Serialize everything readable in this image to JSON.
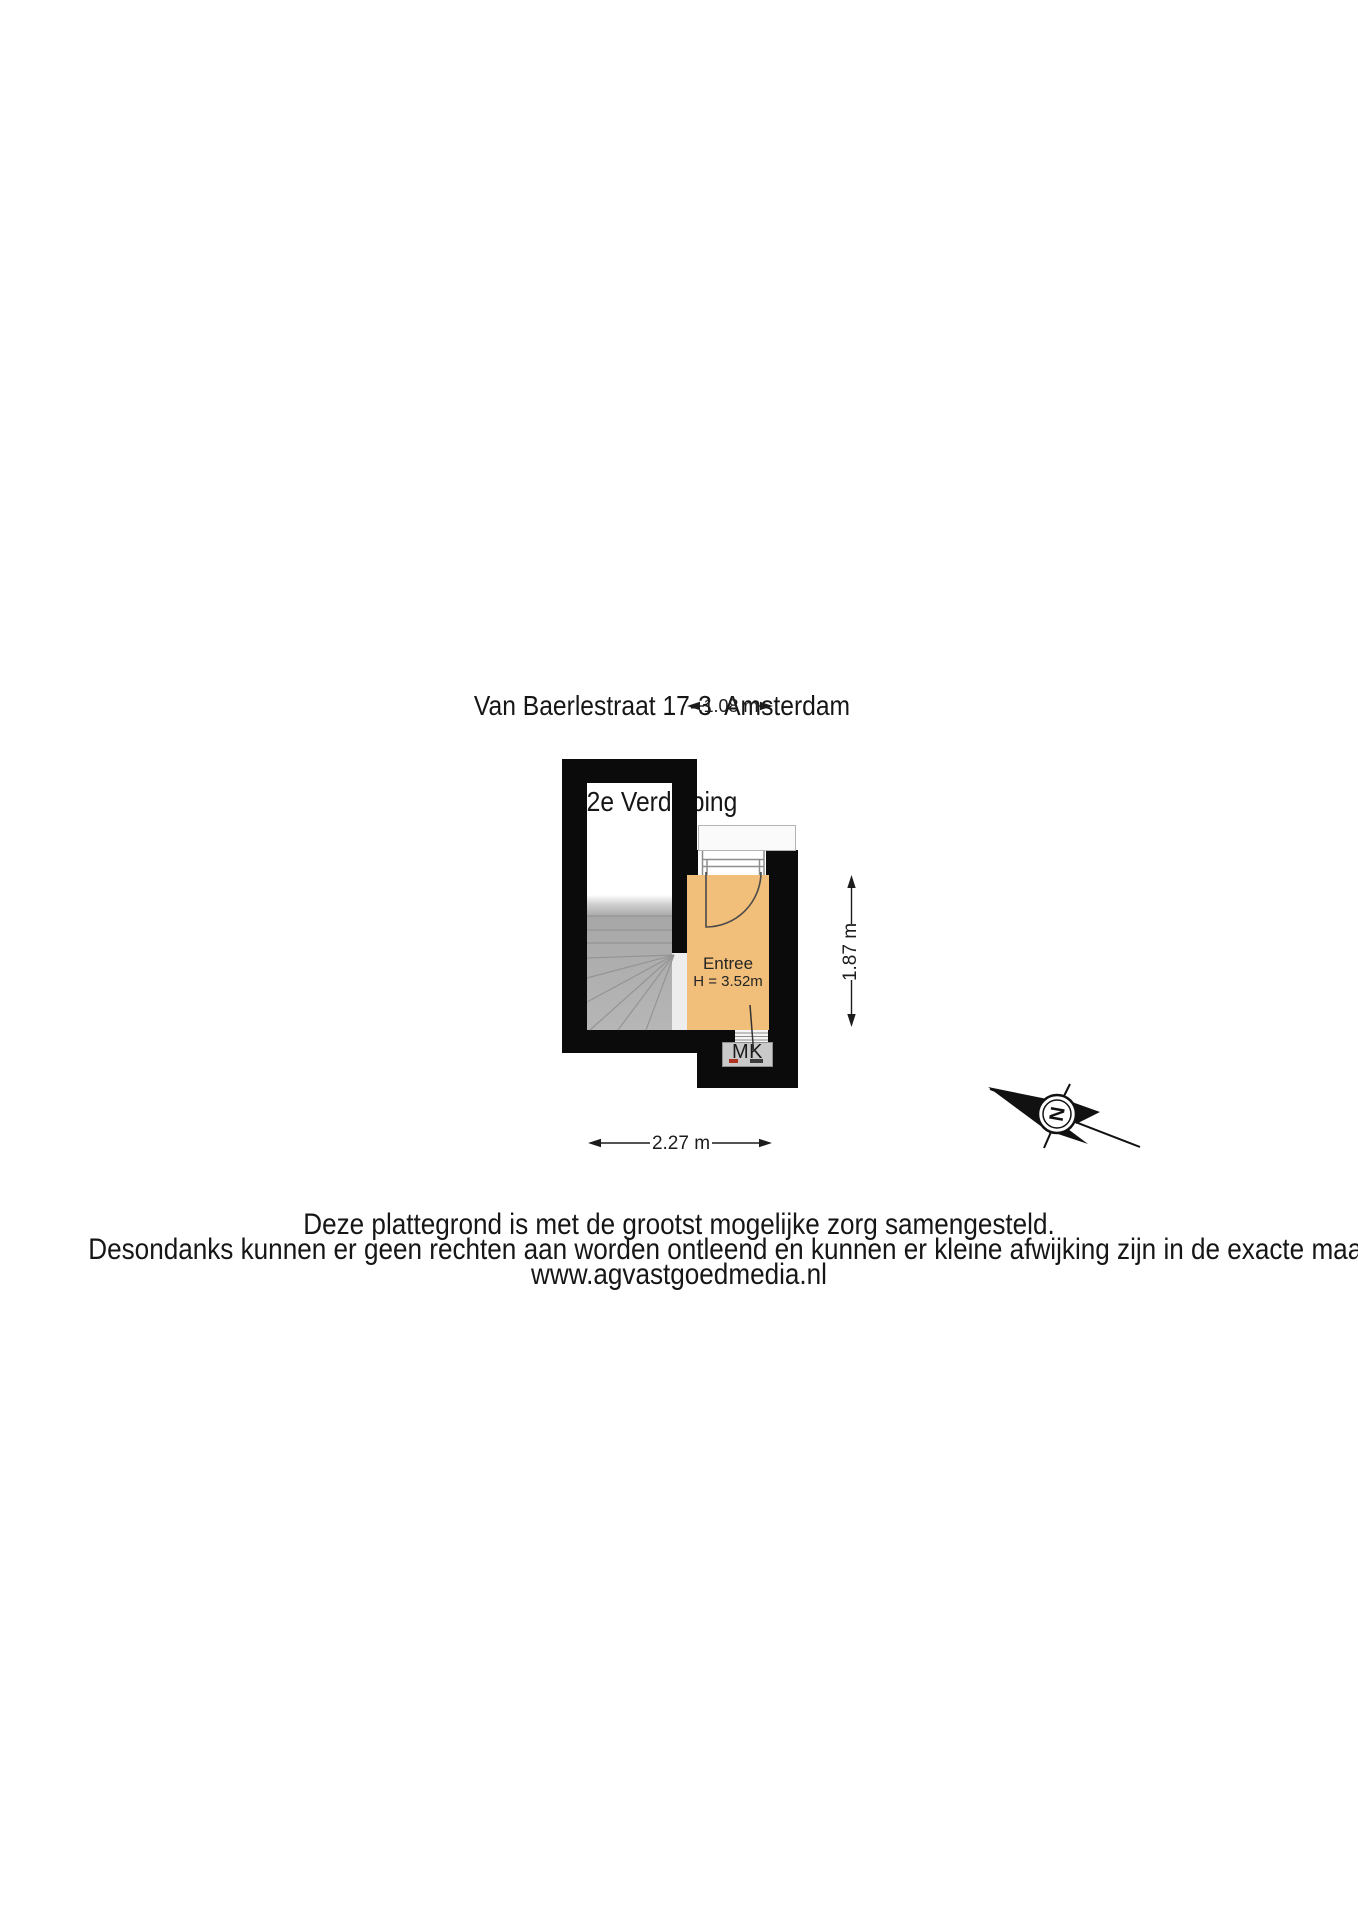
{
  "title": {
    "line1": "Van Baerlestraat 17-3  Amsterdam",
    "line2": "2e Verdieping"
  },
  "plan": {
    "floor_name": "2e Verdieping",
    "room": {
      "name": "Entree",
      "ceiling_height": "H = 3.52m"
    },
    "meter_closet_label": "MK",
    "dim_top": "1.08 m",
    "dim_right": "1.87 m",
    "dim_bottom": "2.27 m",
    "compass_letter": "N",
    "colors": {
      "wall": "#0b0b0b",
      "room_fill": "#f2bf7a",
      "stairs_fill": "#b1b1b1",
      "passage_fill": "#ededed",
      "mk_fill": "#c9c9c9",
      "dimension_line": "#1c1c1c"
    }
  },
  "footer": {
    "line1": "Deze plattegrond is met de grootst mogelijke zorg samengesteld.",
    "line2": "Desondanks kunnen er geen rechten aan worden ontleend en kunnen er kleine afwijking zijn in de exacte maatvoering.",
    "line3": "www.agvastgoedmedia.nl"
  }
}
